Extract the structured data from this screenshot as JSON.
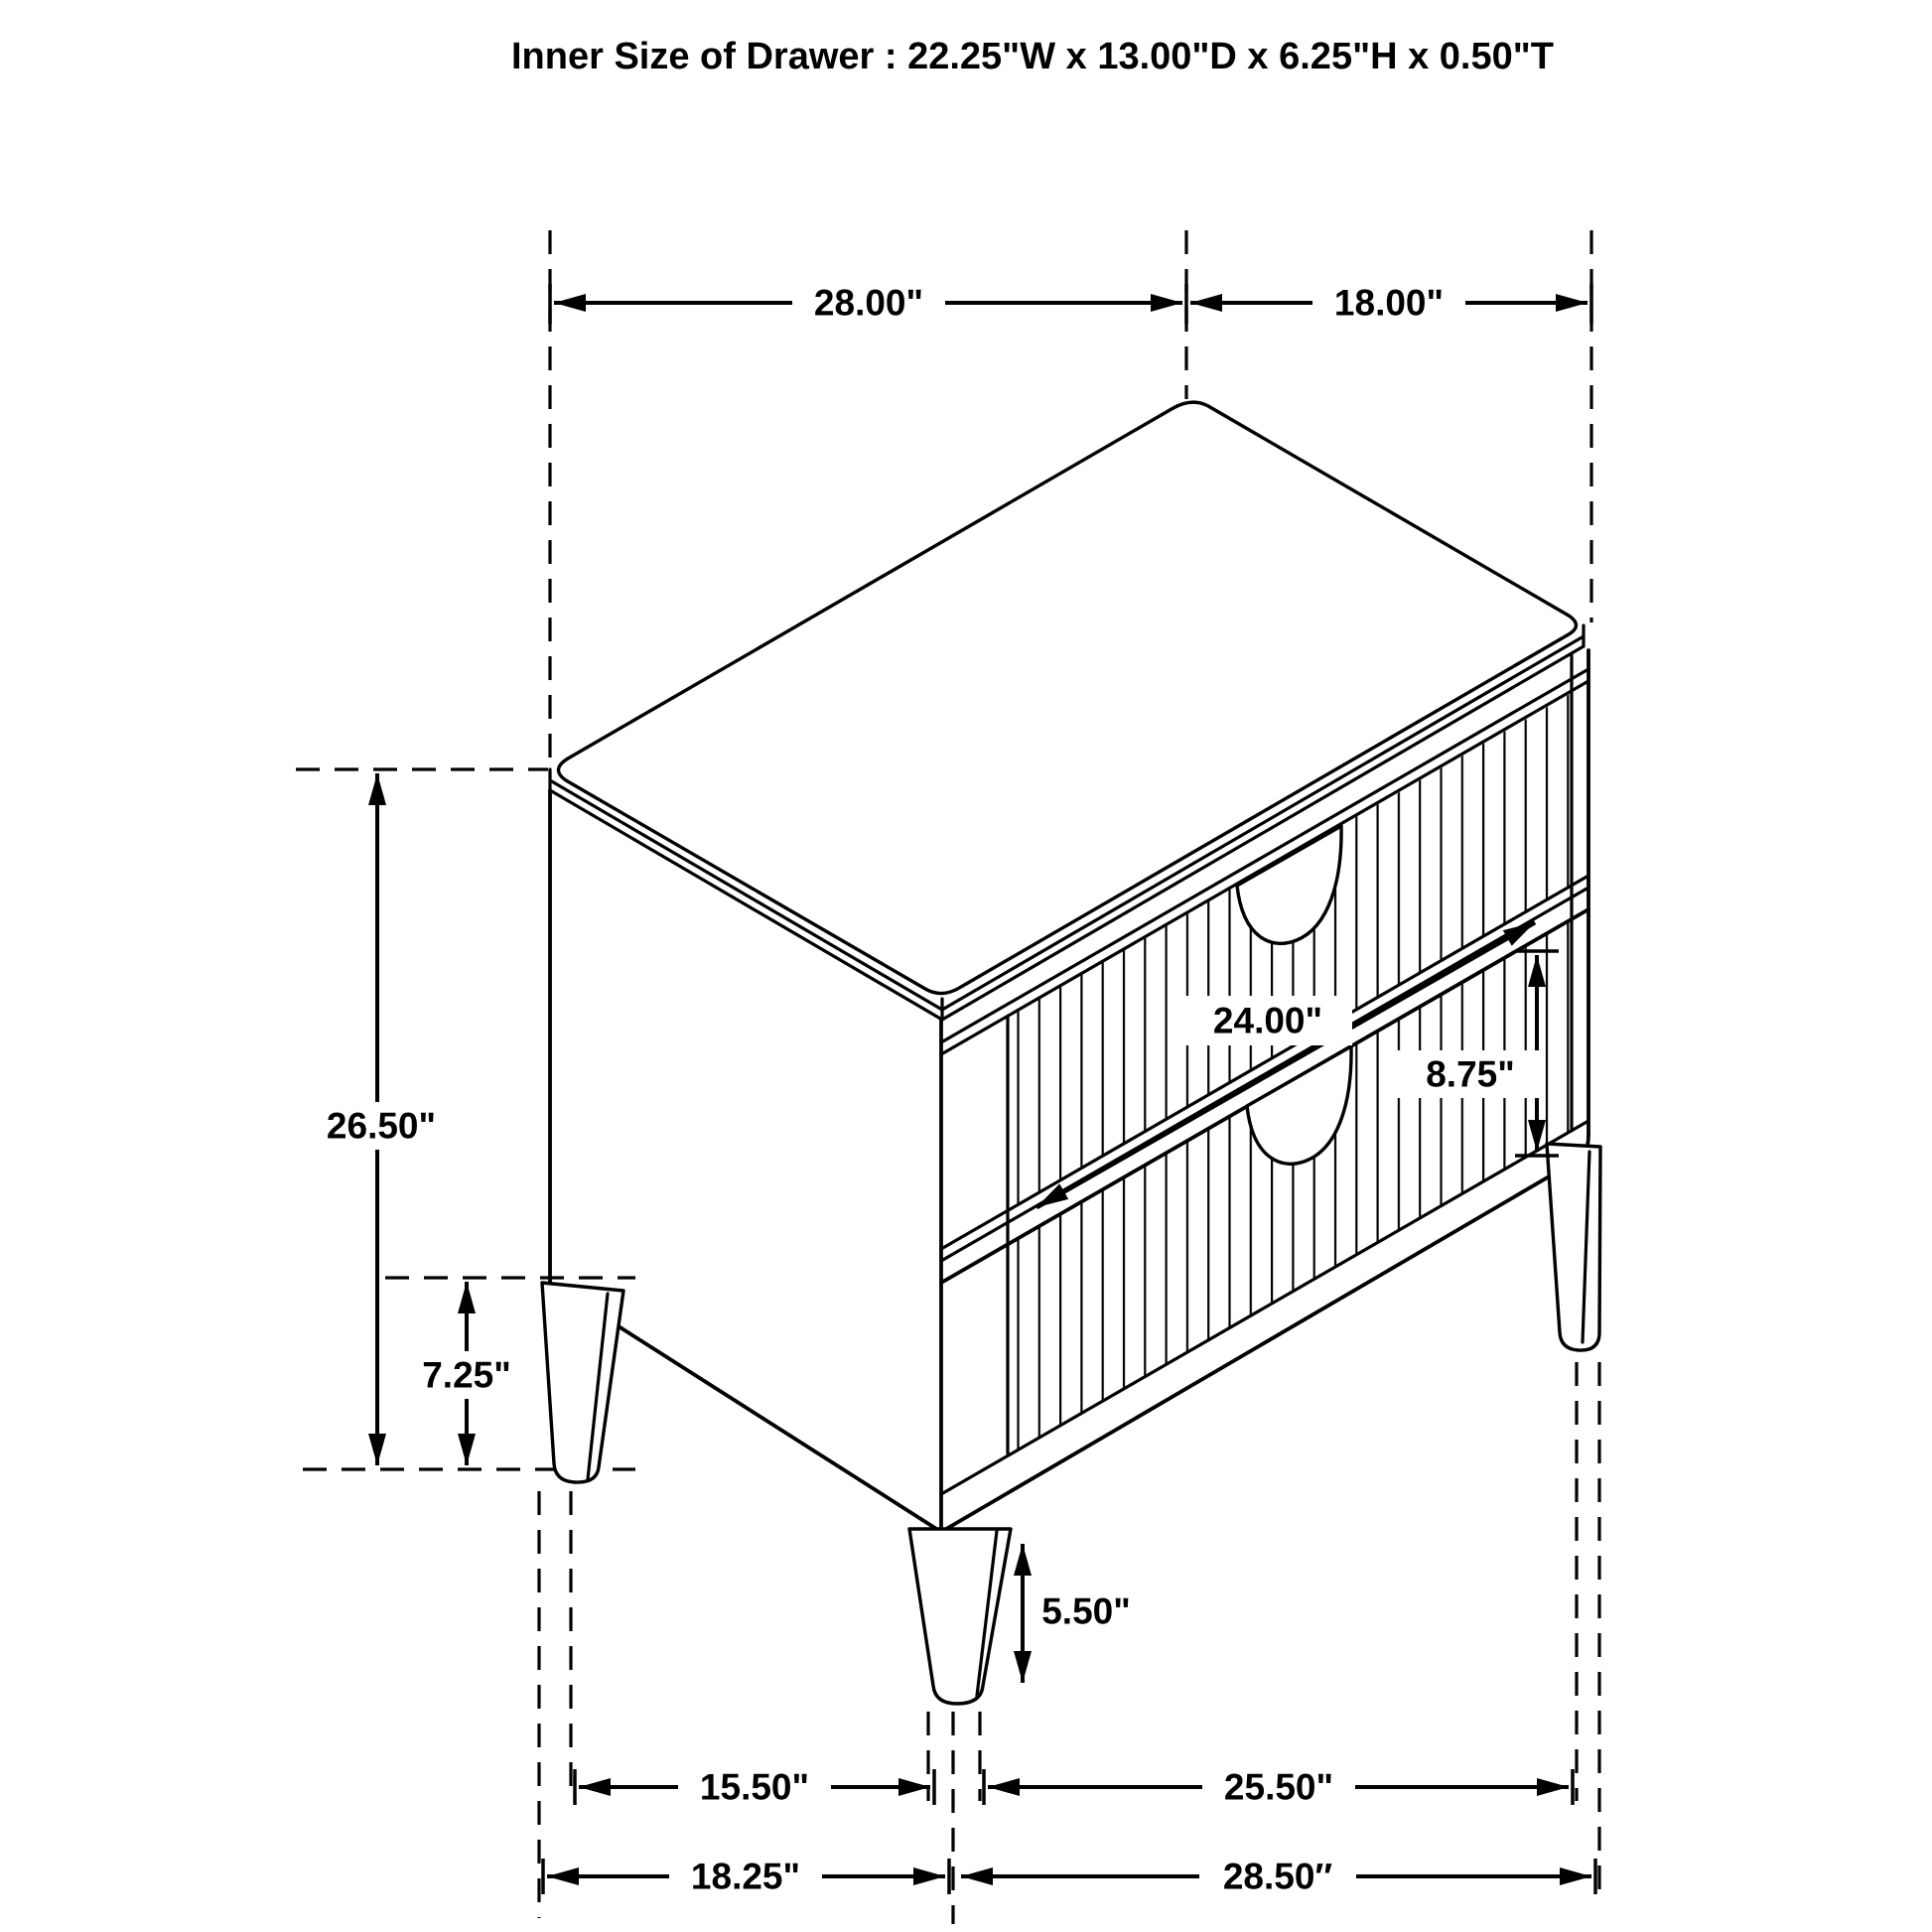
{
  "page": {
    "background": "#ffffff",
    "line_color": "#000000"
  },
  "title": "Inner Size of Drawer : 22.25\"W x 13.00\"D x 6.25\"H x 0.50\"T",
  "dimensions": {
    "top_width": "28.00\"",
    "top_depth": "18.00\"",
    "overall_height": "26.50\"",
    "leg_front_height": "7.25\"",
    "drawer_width": "24.00\"",
    "drawer_front_height": "8.75\"",
    "leg_height": "5.50\"",
    "legs_side_spacing": "15.50\"",
    "legs_front_spacing": "25.50\"",
    "base_side_depth": "18.25\"",
    "base_front_width": "28.50″"
  }
}
